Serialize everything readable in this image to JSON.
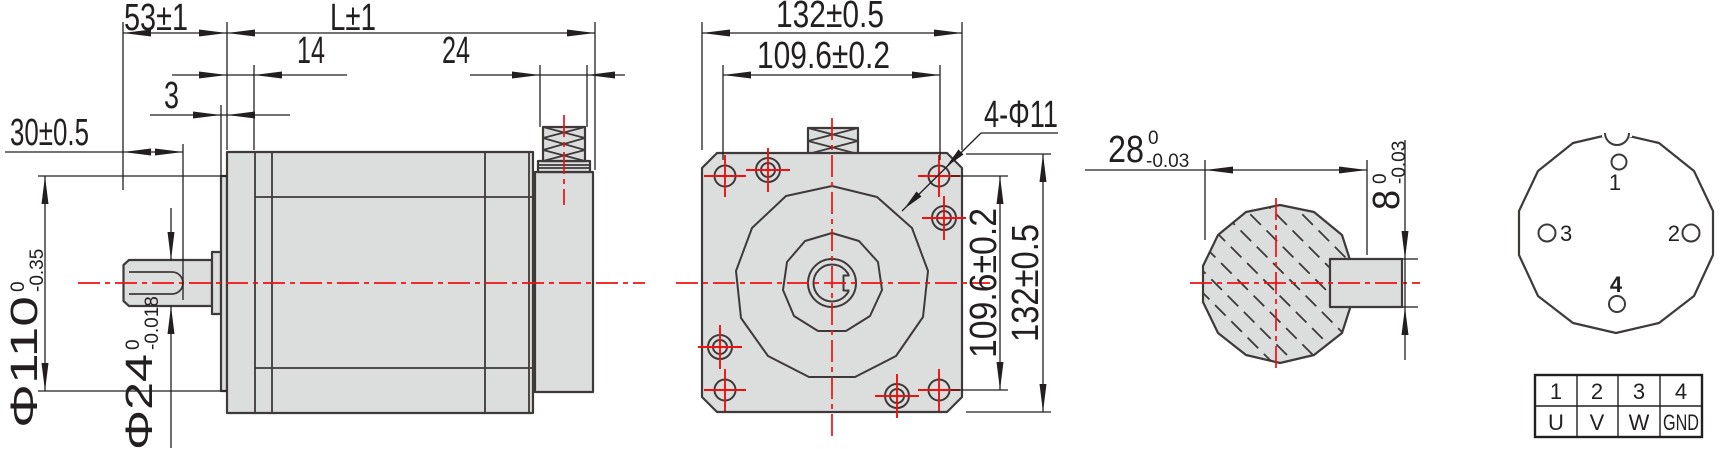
{
  "side_view": {
    "shaft_length": "53±1",
    "body_length": "L±1",
    "front_plate": "14",
    "connector_width": "24",
    "spigot_depth": "3",
    "key_length": "30±0.5",
    "flange_dia": {
      "main": "Φ110",
      "tol_sup": "0",
      "tol_sub": "-0.35"
    },
    "shaft_dia": {
      "main": "Φ24",
      "tol_sup": "0",
      "tol_sub": "-0.018"
    }
  },
  "front_view": {
    "width": "132±0.5",
    "bolt_spacing": "109.6±0.2",
    "holes_label": "4-Φ11",
    "bolt_spacing_v": "109.6±0.2",
    "height": "132±0.5"
  },
  "shaft_section": {
    "across_flat": {
      "main": "28",
      "tol_sup": "0",
      "tol_sub": "-0.03"
    },
    "key_width": {
      "main": "8",
      "tol_sup": "0",
      "tol_sub": "-0.03"
    }
  },
  "connector": {
    "pins": [
      "1",
      "2",
      "3",
      "4"
    ]
  },
  "wiring_table": {
    "headers": [
      "1",
      "2",
      "3",
      "4"
    ],
    "values": [
      "U",
      "V",
      "W",
      "GND"
    ]
  },
  "colors": {
    "body_fill": "#dcdddd",
    "outline": "#3e3a39",
    "centerline_red": "#f01010",
    "dimension": "#231f20",
    "background": "#ffffff"
  }
}
